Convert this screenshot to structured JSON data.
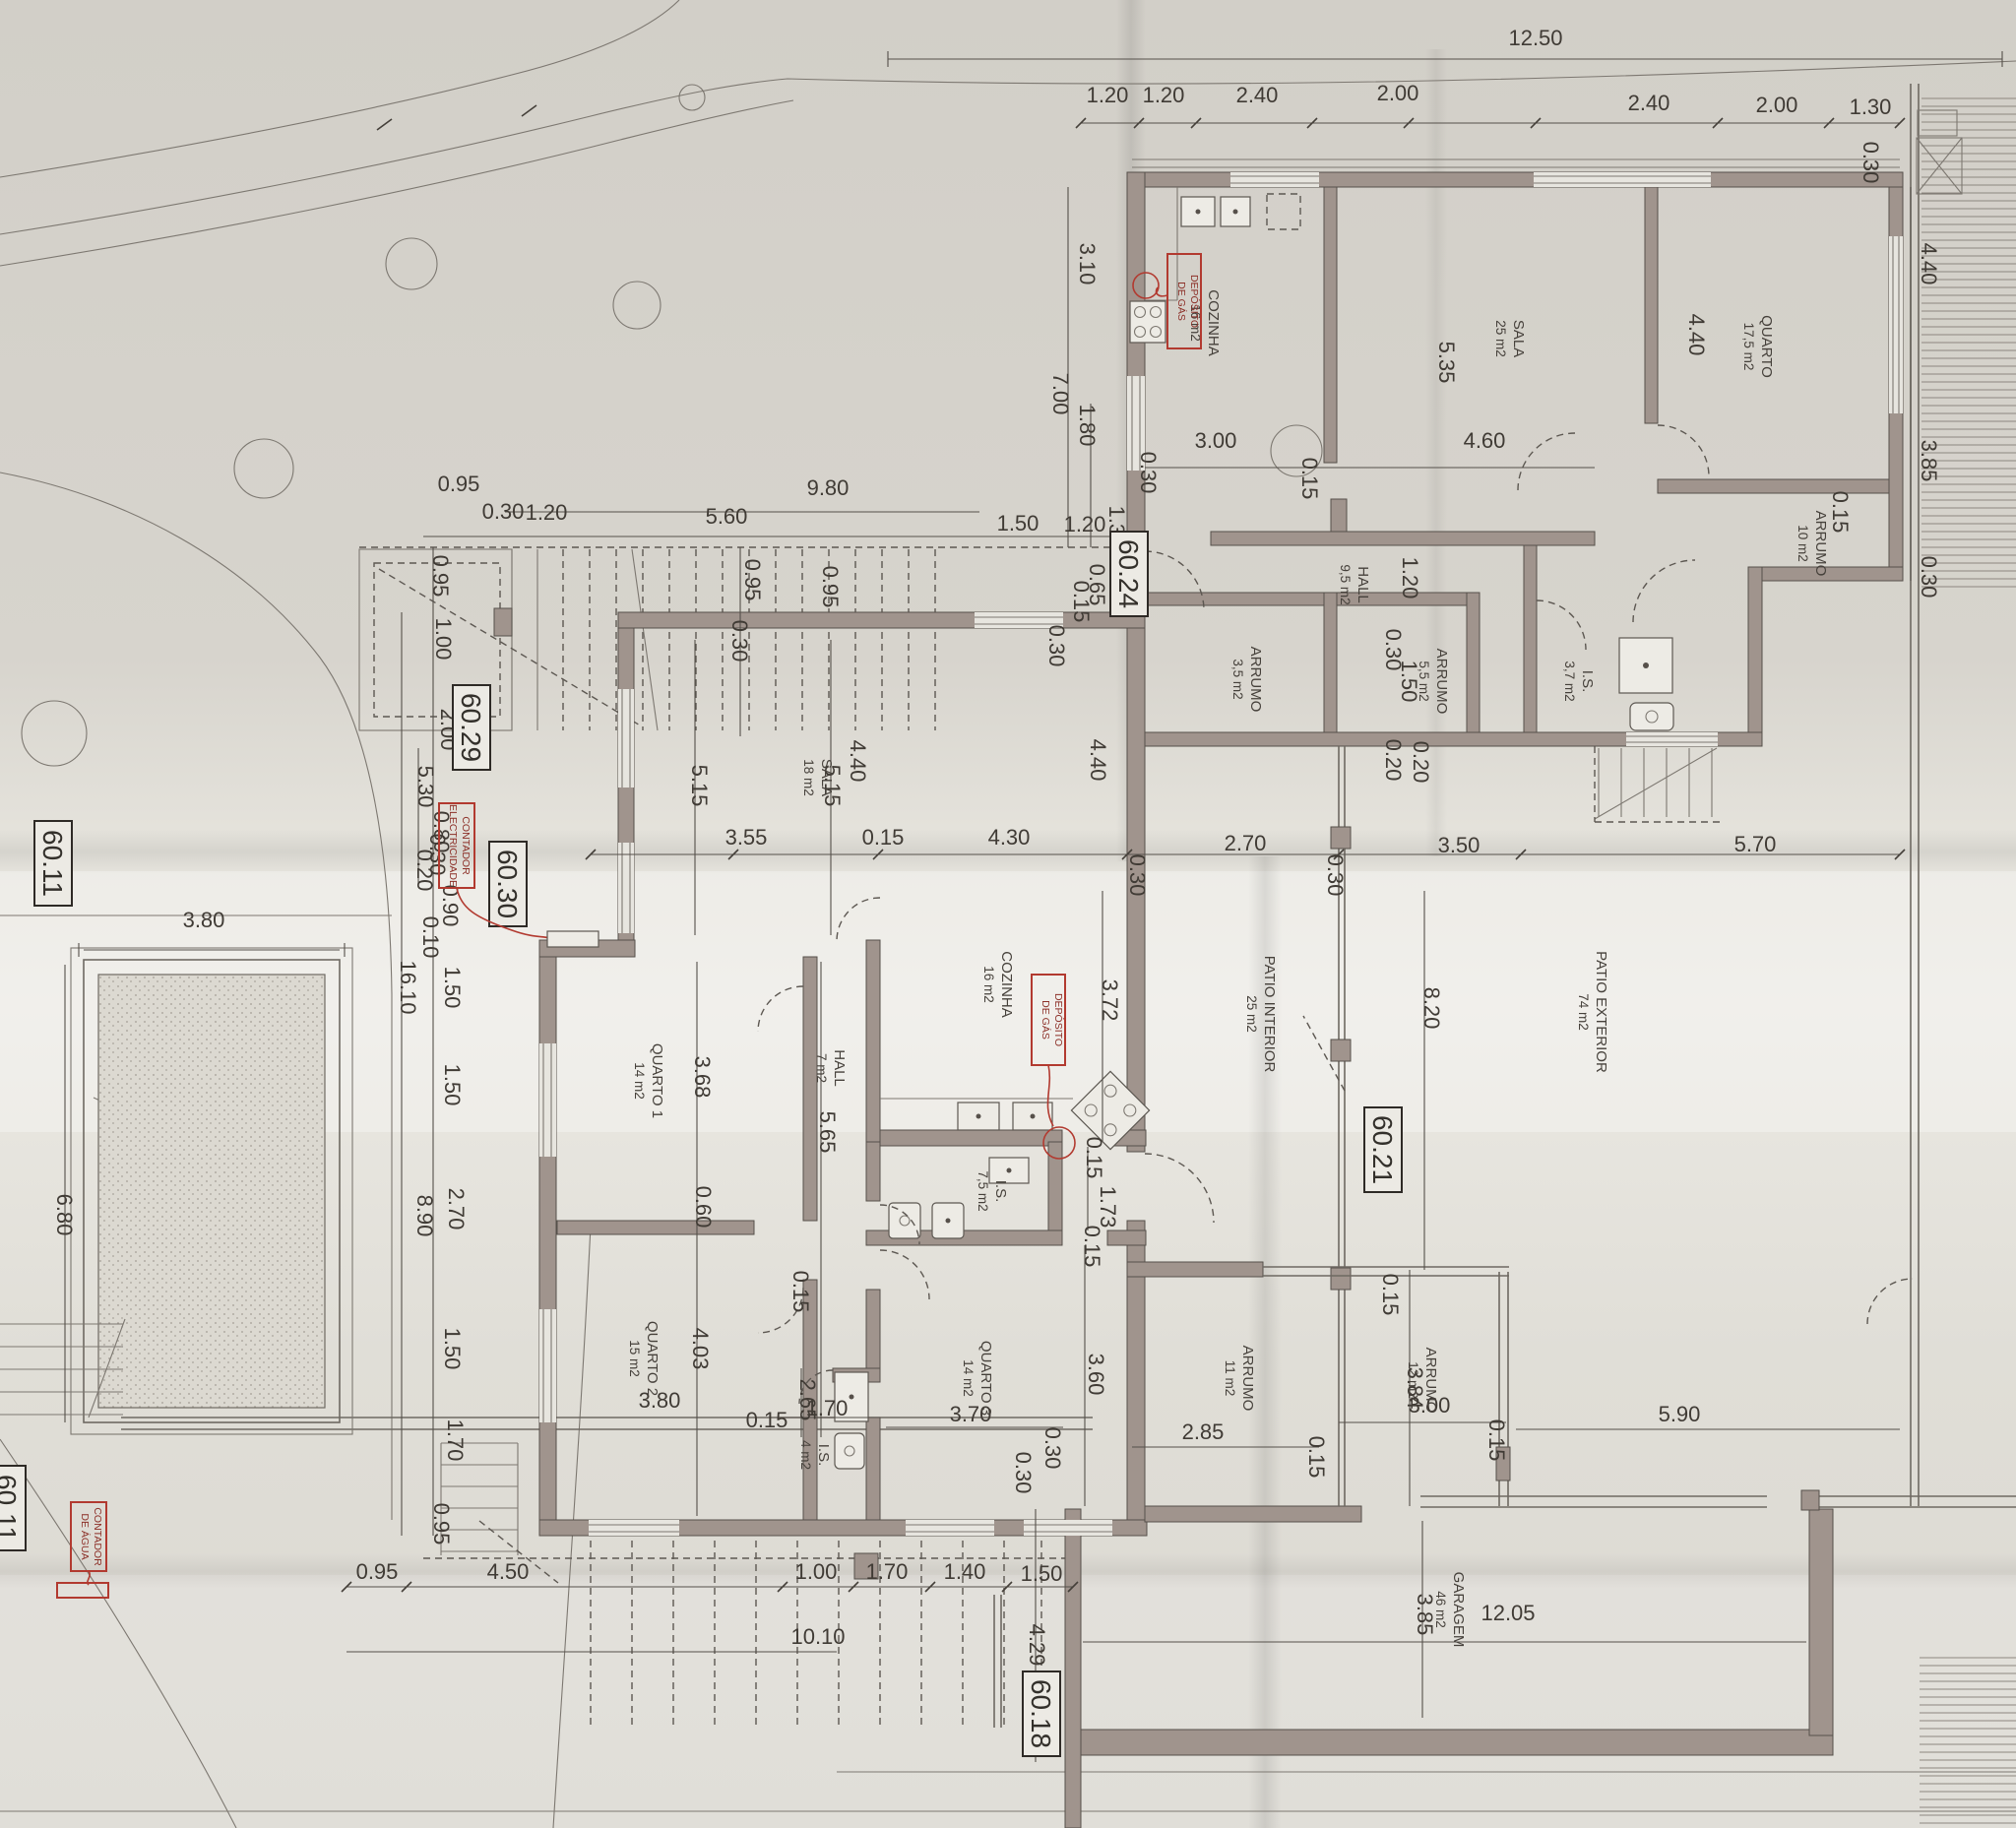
{
  "markers": {
    "m6024": "60.24",
    "m6029": "60.29",
    "m6030": "60.30",
    "m6011": "60.11",
    "m6021": "60.21",
    "m6018": "60.18",
    "m6011b": "60.11"
  },
  "red": {
    "gas1a": "DEPÓSITO",
    "gas1b": "DE GÁS",
    "gas2a": "DEPÓSITO",
    "gas2b": "DE GÁS",
    "eleca": "CONTADOR",
    "elecb": "ELECTRICIDADE",
    "aguaa": "CONTADOR",
    "aguab": "DE ÁGUA"
  },
  "rooms": {
    "cozinha1": {
      "n": "COZINHA",
      "a": "16 m2"
    },
    "sala1": {
      "n": "SALA",
      "a": "25 m2"
    },
    "quarto_u": {
      "n": "QUARTO",
      "a": "17,5 m2"
    },
    "arrumo10": {
      "n": "ARRUMO",
      "a": "10 m2"
    },
    "hall_u": {
      "n": "HALL",
      "a": "9,5 m2"
    },
    "arrumo35": {
      "n": "ARRUMO",
      "a": "3,5 m2"
    },
    "arrumo55": {
      "n": "ARRUMO",
      "a": "5,5 m2"
    },
    "is37": {
      "n": "I.S.",
      "a": "3,7 m2"
    },
    "sala2": {
      "n": "SALA",
      "a": "18 m2"
    },
    "cozinha2": {
      "n": "COZINHA",
      "a": "16 m2"
    },
    "quarto1": {
      "n": "QUARTO 1",
      "a": "14 m2"
    },
    "hall_l": {
      "n": "HALL",
      "a": "7 m2"
    },
    "quarto2": {
      "n": "QUARTO 2",
      "a": "15 m2"
    },
    "is4": {
      "n": "I.S.",
      "a": "4 m2"
    },
    "quarto3": {
      "n": "QUARTO 3",
      "a": "14 m2"
    },
    "is75": {
      "n": "I.S.",
      "a": "7,5 m2"
    },
    "arrumo11": {
      "n": "ARRUMO",
      "a": "11 m2"
    },
    "arrumo12": {
      "n": "ARRUMO",
      "a": "12 m2"
    },
    "patio_int": {
      "n": "PATIO INTERIOR",
      "a": "25 m2"
    },
    "patio_ext": {
      "n": "PATIO EXTERIOR",
      "a": "74 m2"
    },
    "garagem": {
      "n": "GARAGEM",
      "a": "46 m2"
    }
  },
  "chains": {
    "top": [
      "12.50",
      "1.20",
      "1.20",
      "2.40",
      "2.00",
      "2.40",
      "2.00",
      "1.30",
      "0.30"
    ],
    "upper_left": [
      "3.10",
      "7.00",
      "1.80"
    ],
    "upper_right": [
      "4.40",
      "3.85",
      "0.30"
    ],
    "upper_inner": [
      "5.35",
      "3.00",
      "0.30",
      "0.15",
      "4.60",
      "4.40",
      "0.15"
    ],
    "hall_upper": [
      "1.20",
      "0.30",
      "1.50",
      "0.20"
    ],
    "mid": [
      "9.80",
      "0.95",
      "0.30",
      "1.20",
      "5.60",
      "1.50",
      "1.20",
      "1.30",
      "0.65",
      "0.15",
      "0.30",
      "0.95",
      "0.95",
      "0.30"
    ],
    "left": [
      "16.10",
      "0.95",
      "1.00",
      "2.00",
      "5.30",
      "0.80",
      "0.30",
      "0.20",
      "0.90",
      "0.10",
      "1.50",
      "1.50",
      "2.70",
      "8.90",
      "1.50",
      "1.70",
      "0.95"
    ],
    "sala2": [
      "5.15",
      "5.15",
      "3.55",
      "0.15",
      "4.40",
      "4.40"
    ],
    "mid_section": [
      "4.30",
      "0.30",
      "2.70",
      "0.30",
      "3.50",
      "5.70"
    ],
    "kitchen2": [
      "3.72",
      "0.15",
      "1.73",
      "0.15"
    ],
    "rooms_lower": [
      "3.68",
      "0.60",
      "5.65",
      "0.15",
      "4.03",
      "3.80",
      "0.15",
      "2.65",
      "1.70",
      "3.70",
      "3.60",
      "0.30",
      "0.30"
    ],
    "patio": [
      "8.20",
      "0.20"
    ],
    "arrumos": [
      "2.85",
      "0.15",
      "3.84",
      "3.00",
      "0.15",
      "0.15"
    ],
    "garage": [
      "5.90",
      "12.05",
      "3.85",
      "4.29"
    ],
    "bottom": [
      "0.95",
      "4.50",
      "1.00",
      "1.70",
      "1.40",
      "1.50",
      "10.10"
    ],
    "pool": [
      "3.80",
      "6.80"
    ]
  }
}
